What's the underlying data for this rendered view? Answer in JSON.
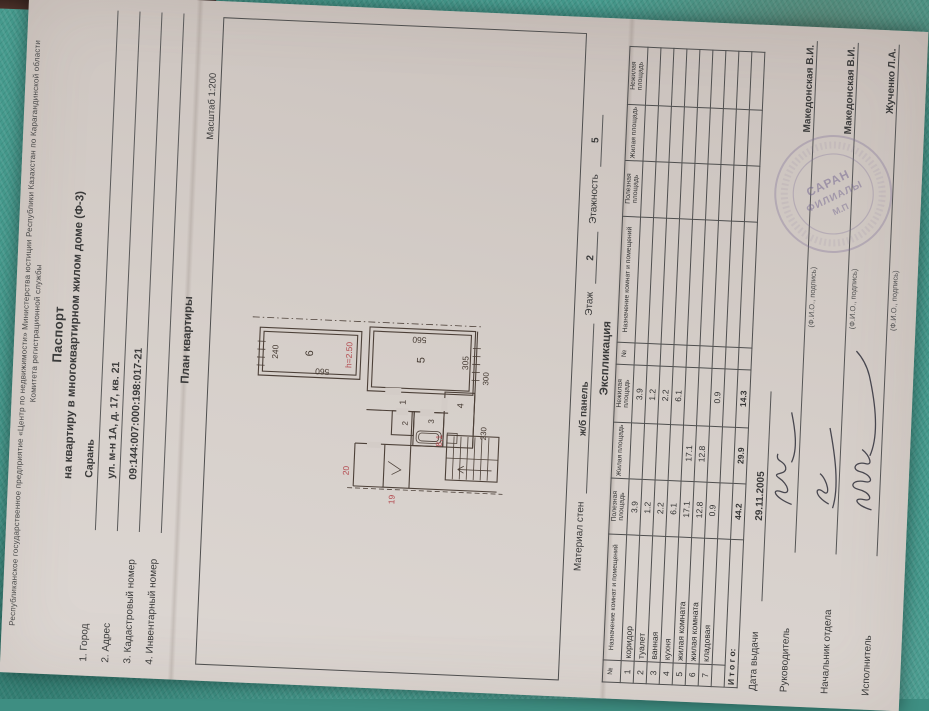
{
  "colors": {
    "cloth": "#459a8d",
    "paper": "#d5cec9",
    "ink_red": "#b34a4f",
    "stamp": "#7a6c96"
  },
  "header": {
    "line1": "Республиканское государственное предприятие «Центр по недвижимости» Министерства юстиции Республики Казахстан по Карагандинской области",
    "line2": "Комитета регистрационной службы",
    "title": "Паспорт",
    "subtitle": "на квартиру в многоквартирном жилом доме (Ф-3)"
  },
  "fields": [
    {
      "label": "1. Город",
      "value": "Сарань"
    },
    {
      "label": "2. Адрес",
      "value": "ул. м-н 1А, д. 17, кв. 21"
    },
    {
      "label": "3. Кадастровый номер",
      "value": "09:144:007:000:198:017-21"
    },
    {
      "label": "4. Инвентарный номер",
      "value": ""
    }
  ],
  "plan": {
    "heading": "План квартиры",
    "scale_label": "Масштаб 1:200",
    "labels": {
      "r1": "1",
      "r2": "2",
      "r3": "3",
      "r4": "4",
      "r5": "5",
      "r6": "6",
      "d240": "240",
      "d560a": "560",
      "d560b": "560",
      "d305": "305",
      "d230": "230",
      "d300": "300",
      "h": "h=2.50",
      "m81": "8,1",
      "m20": "20",
      "m19": "19"
    }
  },
  "materials": {
    "label": "Материал стен",
    "value": "ж/б панель",
    "floor_label": "Этаж",
    "floor": "2",
    "floors_label": "Этажность",
    "floors": "5"
  },
  "exp": {
    "title": "Экспликация",
    "headers": {
      "num": "№",
      "name": "Назначение комнат и помещений",
      "useful": "Полезная площадь",
      "living": "Жилая площадь",
      "nonliving": "Нежилая площадь"
    },
    "rows": [
      {
        "n": "1",
        "name": "коридор",
        "u": "3.9",
        "l": "",
        "nl": "3.9"
      },
      {
        "n": "2",
        "name": "туалет",
        "u": "1.2",
        "l": "",
        "nl": "1.2"
      },
      {
        "n": "3",
        "name": "ванная",
        "u": "2.2",
        "l": "",
        "nl": "2.2"
      },
      {
        "n": "4",
        "name": "кухня",
        "u": "6.1",
        "l": "",
        "nl": "6.1"
      },
      {
        "n": "5",
        "name": "жилая комната",
        "u": "17.1",
        "l": "17.1",
        "nl": ""
      },
      {
        "n": "6",
        "name": "жилая комната",
        "u": "12.8",
        "l": "12.8",
        "nl": ""
      },
      {
        "n": "7",
        "name": "кладовая",
        "u": "0.9",
        "l": "",
        "nl": "0.9"
      }
    ],
    "total": {
      "label": "И т о г о:",
      "u": "44.2",
      "l": "29.9",
      "nl": "14.3"
    }
  },
  "footer": {
    "date_label": "Дата выдачи",
    "date": "29.11.2005",
    "signers": [
      {
        "role": "Руководитель",
        "name": "Македонская В.И.",
        "caption": "(Ф.И.О., подпись)"
      },
      {
        "role": "Начальник отдела",
        "name": "Македонская В.И.",
        "caption": "(Ф.И.О., подпись)"
      },
      {
        "role": "Исполнитель",
        "name": "Жученко Л.А.",
        "caption": "(Ф.И.О., подпись)"
      }
    ]
  },
  "stamp": {
    "line1": "САРАН",
    "line2": "ФИЛИАЛЫ",
    "line3": "М.П"
  }
}
